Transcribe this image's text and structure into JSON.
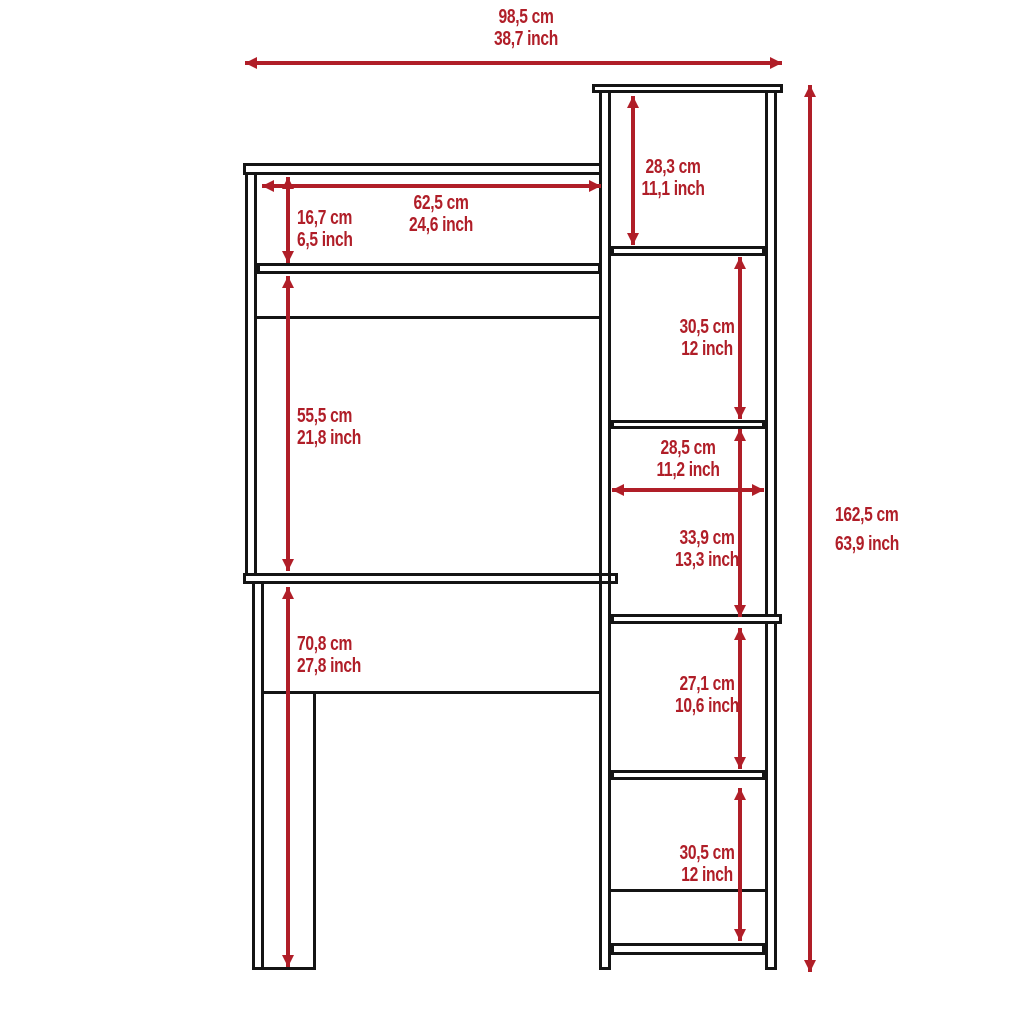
{
  "diagram": {
    "type": "furniture-dimension-drawing",
    "subject": "desk-with-side-bookcase",
    "colors": {
      "dimension_red": "#b01e28",
      "outline_black": "#141414",
      "background": "#ffffff"
    },
    "dimensions": {
      "overall_width": {
        "cm": "98,5 cm",
        "inch": "38,7 inch"
      },
      "overall_height": {
        "cm": "162,5 cm",
        "inch": "63,9 inch"
      },
      "hutch_opening_width": {
        "cm": "62,5 cm",
        "inch": "24,6 inch"
      },
      "hutch_top_compartment": {
        "cm": "16,7 cm",
        "inch": "6,5 inch"
      },
      "hutch_opening_height": {
        "cm": "55,5 cm",
        "inch": "21,8 inch"
      },
      "desk_clearance_height": {
        "cm": "70,8 cm",
        "inch": "27,8 inch"
      },
      "bookcase_compartment_1": {
        "cm": "28,3 cm",
        "inch": "11,1 inch"
      },
      "bookcase_compartment_2": {
        "cm": "30,5 cm",
        "inch": "12 inch"
      },
      "bookcase_inner_width": {
        "cm": "28,5 cm",
        "inch": "11,2 inch"
      },
      "bookcase_compartment_3": {
        "cm": "33,9 cm",
        "inch": "13,3 inch"
      },
      "bookcase_compartment_4": {
        "cm": "27,1 cm",
        "inch": "10,6 inch"
      },
      "bookcase_compartment_5": {
        "cm": "30,5 cm",
        "inch": "12 inch"
      }
    }
  }
}
